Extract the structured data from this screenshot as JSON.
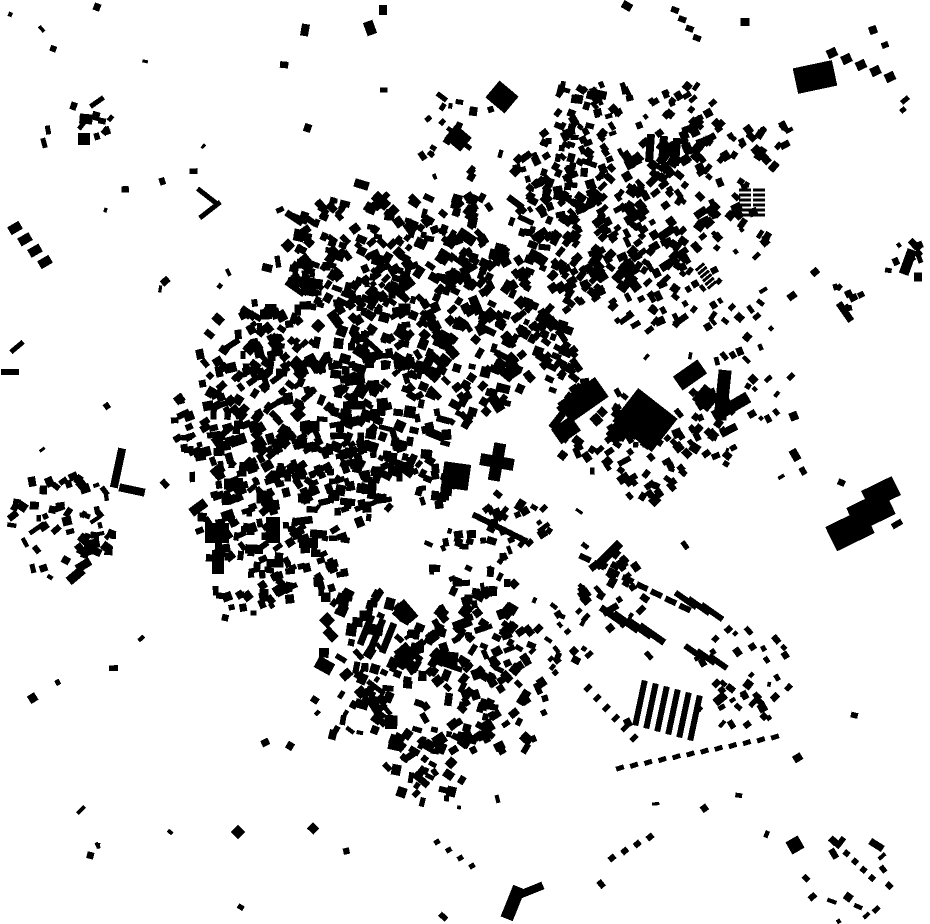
{
  "meta": {
    "width": 930,
    "height": 924,
    "kind": "figure-ground building footprint map"
  },
  "colors": {
    "background": "#ffffff",
    "building": "#000000"
  },
  "map": {
    "seed": 1337,
    "clusters": [
      [
        330,
        325,
        85,
        130,
        5,
        12,
        5,
        12,
        25,
        70
      ],
      [
        415,
        300,
        75,
        105,
        5,
        12,
        5,
        12,
        40,
        60
      ],
      [
        300,
        415,
        75,
        95,
        5,
        12,
        5,
        12,
        -25,
        60
      ],
      [
        385,
        415,
        65,
        85,
        5,
        12,
        5,
        12,
        10,
        60
      ],
      [
        460,
        370,
        55,
        65,
        5,
        11,
        5,
        11,
        35,
        50
      ],
      [
        252,
        362,
        55,
        65,
        5,
        11,
        5,
        11,
        -30,
        60
      ],
      [
        352,
        248,
        65,
        85,
        5,
        11,
        5,
        11,
        30,
        50
      ],
      [
        452,
        240,
        55,
        65,
        5,
        11,
        5,
        11,
        35,
        50
      ],
      [
        520,
        300,
        55,
        70,
        5,
        11,
        5,
        11,
        40,
        50
      ],
      [
        540,
        365,
        45,
        45,
        5,
        10,
        5,
        10,
        40,
        40
      ],
      [
        290,
        480,
        50,
        55,
        5,
        11,
        5,
        11,
        -20,
        50
      ],
      [
        355,
        480,
        45,
        50,
        5,
        11,
        5,
        11,
        0,
        50
      ],
      [
        420,
        470,
        40,
        38,
        5,
        10,
        5,
        10,
        10,
        40
      ],
      [
        595,
        250,
        60,
        80,
        5,
        11,
        5,
        11,
        -40,
        35
      ],
      [
        655,
        205,
        65,
        85,
        5,
        11,
        5,
        11,
        -40,
        35
      ],
      [
        640,
        285,
        55,
        60,
        5,
        10,
        5,
        10,
        -40,
        35
      ],
      [
        715,
        165,
        55,
        45,
        5,
        10,
        5,
        10,
        -40,
        40
      ],
      [
        560,
        175,
        45,
        45,
        5,
        10,
        5,
        10,
        -30,
        40
      ],
      [
        608,
        120,
        40,
        35,
        4,
        9,
        4,
        9,
        -30,
        40
      ],
      [
        680,
        120,
        40,
        25,
        4,
        9,
        4,
        9,
        -35,
        40
      ],
      [
        740,
        230,
        35,
        14,
        4,
        9,
        4,
        9,
        -40,
        40
      ],
      [
        700,
        300,
        35,
        14,
        4,
        8,
        4,
        8,
        -40,
        40
      ],
      [
        545,
        215,
        35,
        32,
        5,
        10,
        5,
        10,
        25,
        40
      ],
      [
        560,
        160,
        30,
        22,
        5,
        9,
        5,
        9,
        20,
        40
      ],
      [
        575,
        105,
        28,
        18,
        4,
        9,
        4,
        9,
        20,
        40
      ],
      [
        460,
        135,
        45,
        16,
        4,
        9,
        4,
        9,
        30,
        50
      ],
      [
        600,
        430,
        50,
        50,
        5,
        11,
        5,
        11,
        -40,
        40
      ],
      [
        650,
        460,
        45,
        40,
        5,
        10,
        5,
        10,
        -40,
        40
      ],
      [
        705,
        435,
        45,
        25,
        5,
        10,
        5,
        10,
        -40,
        40
      ],
      [
        745,
        330,
        35,
        12,
        4,
        9,
        4,
        9,
        -40,
        40
      ],
      [
        775,
        395,
        30,
        10,
        4,
        9,
        4,
        9,
        -40,
        40
      ],
      [
        430,
        690,
        70,
        80,
        5,
        12,
        5,
        14,
        30,
        60
      ],
      [
        370,
        640,
        55,
        55,
        5,
        12,
        5,
        13,
        25,
        50
      ],
      [
        480,
        640,
        50,
        50,
        5,
        11,
        5,
        12,
        -40,
        50
      ],
      [
        500,
        710,
        50,
        40,
        5,
        11,
        5,
        12,
        -40,
        50
      ],
      [
        430,
        760,
        45,
        35,
        4,
        10,
        4,
        11,
        30,
        50
      ],
      [
        350,
        700,
        40,
        25,
        4,
        10,
        4,
        10,
        30,
        50
      ],
      [
        225,
        455,
        45,
        45,
        5,
        11,
        5,
        11,
        -20,
        50
      ],
      [
        235,
        520,
        40,
        35,
        5,
        10,
        5,
        10,
        -20,
        50
      ],
      [
        250,
        570,
        45,
        40,
        5,
        10,
        5,
        10,
        -15,
        50
      ],
      [
        305,
        560,
        45,
        50,
        5,
        10,
        5,
        10,
        -10,
        50
      ],
      [
        205,
        420,
        35,
        25,
        5,
        10,
        5,
        10,
        -20,
        50
      ],
      [
        62,
        525,
        55,
        60,
        4,
        10,
        4,
        10,
        0,
        90
      ],
      [
        87,
        120,
        26,
        8,
        4,
        9,
        4,
        9,
        10,
        60
      ],
      [
        745,
        680,
        55,
        40,
        4,
        9,
        4,
        9,
        -40,
        30
      ],
      [
        610,
        590,
        40,
        30,
        4,
        10,
        4,
        10,
        -50,
        40
      ],
      [
        560,
        640,
        35,
        20,
        4,
        9,
        4,
        9,
        -50,
        40
      ],
      [
        470,
        560,
        45,
        35,
        4,
        10,
        4,
        10,
        0,
        60
      ],
      [
        520,
        520,
        35,
        22,
        4,
        9,
        4,
        9,
        -40,
        40
      ],
      [
        770,
        140,
        28,
        12,
        4,
        9,
        4,
        9,
        -40,
        40
      ],
      [
        905,
        255,
        18,
        7,
        4,
        8,
        4,
        8,
        -30,
        40
      ],
      [
        855,
        290,
        20,
        7,
        4,
        8,
        4,
        8,
        -30,
        40
      ],
      [
        850,
        880,
        45,
        15,
        4,
        9,
        4,
        9,
        40,
        40
      ]
    ],
    "row_groups": [
      [
        640,
        703,
        11,
        3,
        6,
        6,
        46,
        12
      ],
      [
        613,
        616,
        13,
        6,
        4,
        7,
        30,
        -55
      ],
      [
        686,
        600,
        13,
        6,
        3,
        6,
        26,
        -55
      ],
      [
        694,
        652,
        12,
        5,
        3,
        6,
        22,
        -55
      ],
      [
        650,
        148,
        13,
        2,
        3,
        8,
        28,
        4
      ],
      [
        366,
        630,
        11,
        4,
        3,
        7,
        32,
        22
      ]
    ],
    "dot_rows": [
      [
        585,
        558,
        685,
        608,
        8,
        12,
        6,
        25
      ],
      [
        620,
        768,
        775,
        737,
        12,
        8,
        5,
        -18
      ],
      [
        476,
        516,
        524,
        540,
        10,
        7,
        6,
        25
      ],
      [
        832,
        53,
        890,
        77,
        5,
        10,
        9,
        -25
      ],
      [
        700,
        267,
        712,
        285,
        6,
        11,
        3,
        -40
      ],
      [
        745,
        190,
        745,
        215,
        6,
        12,
        3,
        0
      ],
      [
        759,
        190,
        759,
        215,
        6,
        12,
        3,
        0
      ],
      [
        588,
        688,
        634,
        738,
        6,
        8,
        5,
        -45
      ],
      [
        675,
        10,
        697,
        38,
        4,
        8,
        6,
        20
      ],
      [
        437,
        842,
        472,
        866,
        4,
        6,
        5,
        -30
      ],
      [
        612,
        858,
        650,
        837,
        4,
        7,
        6,
        -40
      ],
      [
        838,
        845,
        872,
        878,
        5,
        6,
        6,
        40
      ],
      [
        15,
        228,
        45,
        262,
        4,
        13,
        9,
        -30
      ]
    ],
    "landmarks": [
      [
        645,
        420,
        50,
        42,
        38
      ],
      [
        583,
        400,
        46,
        24,
        -35
      ],
      [
        690,
        375,
        30,
        17,
        -35
      ],
      [
        723,
        391,
        13,
        42,
        6
      ],
      [
        731,
        407,
        40,
        12,
        -30
      ],
      [
        706,
        398,
        20,
        20,
        40
      ],
      [
        722,
        416,
        9,
        9,
        0
      ],
      [
        752,
        414,
        8,
        7,
        -30
      ],
      [
        713,
        436,
        9,
        8,
        20
      ],
      [
        815,
        77,
        40,
        26,
        -12
      ],
      [
        850,
        530,
        42,
        27,
        -26
      ],
      [
        871,
        511,
        42,
        27,
        -26
      ],
      [
        881,
        493,
        34,
        21,
        -26
      ],
      [
        897,
        524,
        11,
        6,
        -30
      ],
      [
        118,
        468,
        8,
        40,
        12
      ],
      [
        132,
        490,
        26,
        8,
        12
      ],
      [
        207,
        196,
        24,
        5,
        38
      ],
      [
        210,
        210,
        26,
        5,
        -38
      ],
      [
        513,
        903,
        13,
        34,
        22
      ],
      [
        529,
        891,
        30,
        8,
        -22
      ],
      [
        456,
        476,
        27,
        26,
        8
      ],
      [
        497,
        462,
        12,
        38,
        10
      ],
      [
        497,
        462,
        34,
        12,
        10
      ],
      [
        502,
        97,
        25,
        22,
        40
      ],
      [
        458,
        138,
        21,
        18,
        40
      ],
      [
        97,
        102,
        16,
        5,
        -35
      ],
      [
        86,
        119,
        13,
        10,
        5
      ],
      [
        84,
        139,
        12,
        12,
        0
      ],
      [
        48,
        130,
        5,
        9,
        -10
      ],
      [
        44,
        143,
        5,
        10,
        -15
      ],
      [
        10,
        372,
        18,
        6,
        0
      ],
      [
        17,
        347,
        16,
        5,
        -40
      ],
      [
        566,
        430,
        24,
        18,
        -35
      ],
      [
        217,
        533,
        24,
        20,
        0
      ],
      [
        273,
        530,
        14,
        26,
        0
      ],
      [
        218,
        562,
        12,
        24,
        0
      ],
      [
        608,
        555,
        34,
        9,
        -45
      ],
      [
        514,
        584,
        8,
        8,
        45
      ],
      [
        795,
        845,
        14,
        14,
        -30
      ],
      [
        81,
        810,
        10,
        4,
        -45
      ],
      [
        238,
        832,
        10,
        10,
        45
      ],
      [
        845,
        312,
        7,
        22,
        -35
      ],
      [
        908,
        262,
        10,
        26,
        20
      ],
      [
        918,
        277,
        8,
        9,
        0
      ],
      [
        915,
        245,
        14,
        7,
        45
      ],
      [
        792,
        296,
        9,
        7,
        -35
      ],
      [
        765,
        242,
        8,
        8,
        -40
      ],
      [
        815,
        272,
        8,
        7,
        -40
      ],
      [
        305,
        30,
        8,
        12,
        10
      ],
      [
        370,
        28,
        10,
        14,
        -20
      ],
      [
        383,
        10,
        8,
        10,
        0
      ],
      [
        627,
        6,
        10,
        8,
        30
      ],
      [
        745,
        22,
        9,
        8,
        0
      ],
      [
        795,
        455,
        8,
        12,
        -30
      ],
      [
        803,
        471,
        6,
        8,
        -30
      ],
      [
        905,
        100,
        9,
        5,
        -40
      ],
      [
        903,
        110,
        6,
        5,
        -40
      ],
      [
        873,
        30,
        8,
        8,
        -20
      ],
      [
        885,
        45,
        7,
        6,
        -20
      ]
    ],
    "scatter": {
      "count": 90,
      "min_size": 3,
      "max_size": 9
    }
  }
}
